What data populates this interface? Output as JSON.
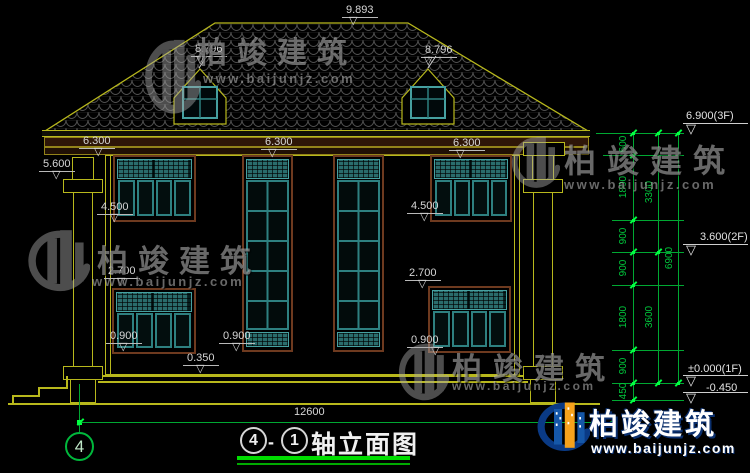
{
  "brand": {
    "name": "柏竣建筑",
    "site": "www.baijunjz.com"
  },
  "title": {
    "axis_start": "4",
    "dash": "-",
    "axis_end": "1",
    "name": "轴立面图"
  },
  "axis_bubble": "4",
  "total_width": "12600",
  "marks": {
    "ridge": "9.893",
    "dormer_left": "8.796",
    "dormer_right": "8.796",
    "eave_left": "6.300",
    "eave_center": "6.300",
    "eave_right": "6.300",
    "porch_top": "5.600",
    "sill_2f_left": "4.500",
    "sill_2f_right": "4.500",
    "win_top_1f_left": "2.700",
    "win_top_1f_right": "2.700",
    "sill_1f_left": "0.900",
    "sill_1f_center": "0.900",
    "sill_1f_right": "0.900",
    "porch_floor": "0.350"
  },
  "levels": [
    "6.900(3F)",
    "3.600(2F)",
    "±0.000(1F)",
    "-0.450"
  ],
  "chain": {
    "segments": [
      "600",
      "1800",
      "900",
      "900",
      "1800",
      "900",
      "450"
    ],
    "subtotals": [
      "3300",
      "3600"
    ],
    "total": "6900"
  },
  "colors": {
    "line_yellow": "#b8b81c",
    "dim_green": "#00a832",
    "tick_green": "#00ff41",
    "frame_brown": "#6e3a1f",
    "glass_teal": "#2e8080",
    "lattice_teal": "#2a6c6c",
    "text_white": "#d6d6d6",
    "title_underline": "#00dd00",
    "logo_blue": "#1557a8",
    "logo_orange": "#f6a21c",
    "logo_navy": "#0a3a85"
  }
}
